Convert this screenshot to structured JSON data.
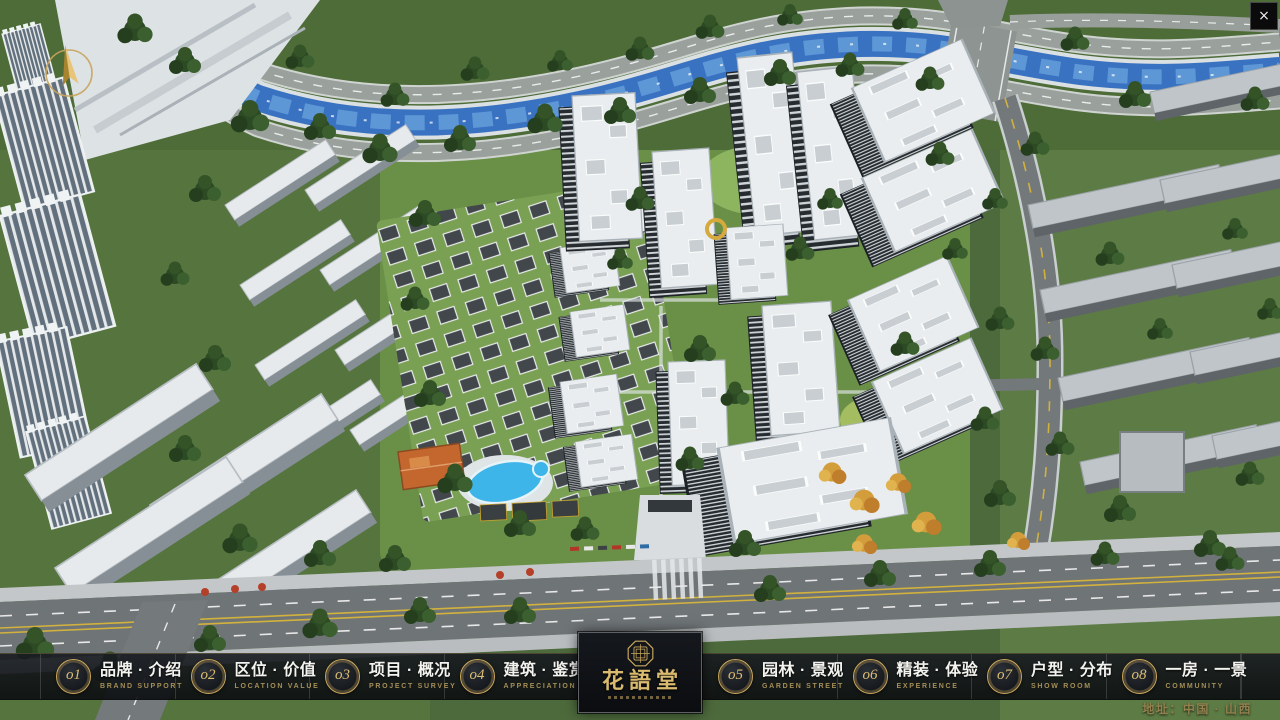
{
  "window": {
    "close_glyph": "×"
  },
  "nav": {
    "items": [
      {
        "num": "o1",
        "zh": "品牌 · 介绍",
        "en": "BRAND SUPPORT"
      },
      {
        "num": "o2",
        "zh": "区位 · 价值",
        "en": "LOCATION VALUE"
      },
      {
        "num": "o3",
        "zh": "项目 · 概况",
        "en": "PROJECT SURVEY"
      },
      {
        "num": "o4",
        "zh": "建筑 · 鉴赏",
        "en": "APPRECIATION"
      },
      {
        "num": "o5",
        "zh": "园林 · 景观",
        "en": "GARDEN STREET"
      },
      {
        "num": "o6",
        "zh": "精装 · 体验",
        "en": "EXPERIENCE"
      },
      {
        "num": "o7",
        "zh": "户型 · 分布",
        "en": "SHOW ROOM"
      },
      {
        "num": "o8",
        "zh": "一房 · 一景",
        "en": "COMMUNITY"
      }
    ]
  },
  "logo": {
    "title": "花語堂"
  },
  "footer": {
    "address": "地址：中国 · 山西"
  },
  "colors": {
    "gold_accent": "#c8a85f",
    "bar_background": "#14171b",
    "river_blue": "#3a72c2"
  }
}
